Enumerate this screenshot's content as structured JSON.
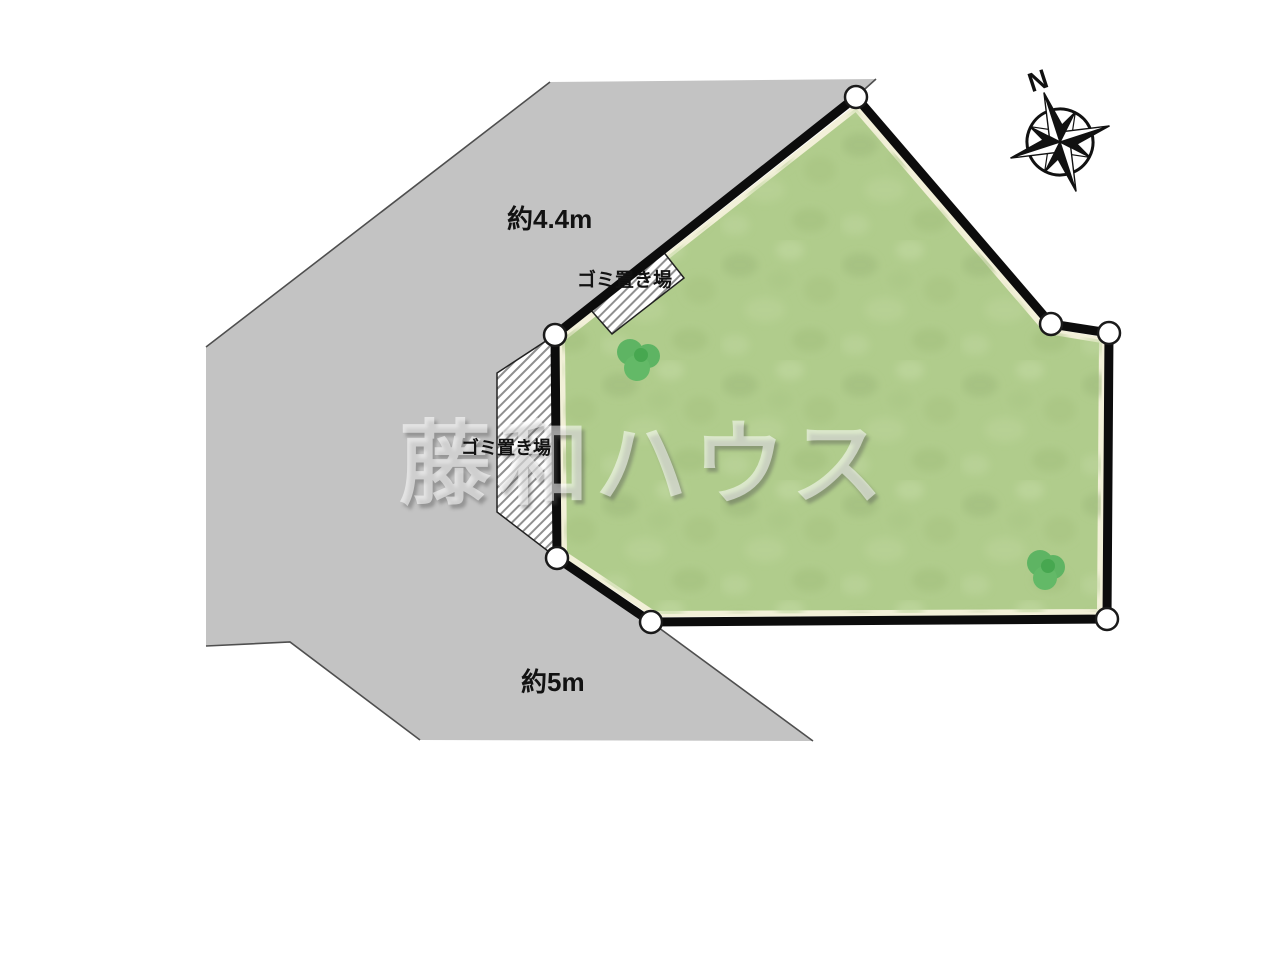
{
  "plan": {
    "title": "site-plan",
    "watermark": "藤和ハウス",
    "compass": {
      "north_label": "N"
    },
    "roads": {
      "top_width_label": "約4.4m",
      "bottom_width_label": "約5m"
    },
    "garbage_areas": {
      "top_label": "ゴミ置き場",
      "left_label": "ゴミ置き場"
    }
  },
  "colors": {
    "road": "#c3c3c3",
    "road_edge_line": "#4f4f4f",
    "plot_fill": "#b0cc8c",
    "plot_border": "#0c0c0c",
    "inner_outline": "#f2f0d8",
    "hatch_stripe": "#8f8f8f",
    "tree": "#5eb463",
    "tree_dark": "#47a750",
    "vertex_marker_fill": "#ffffff"
  }
}
